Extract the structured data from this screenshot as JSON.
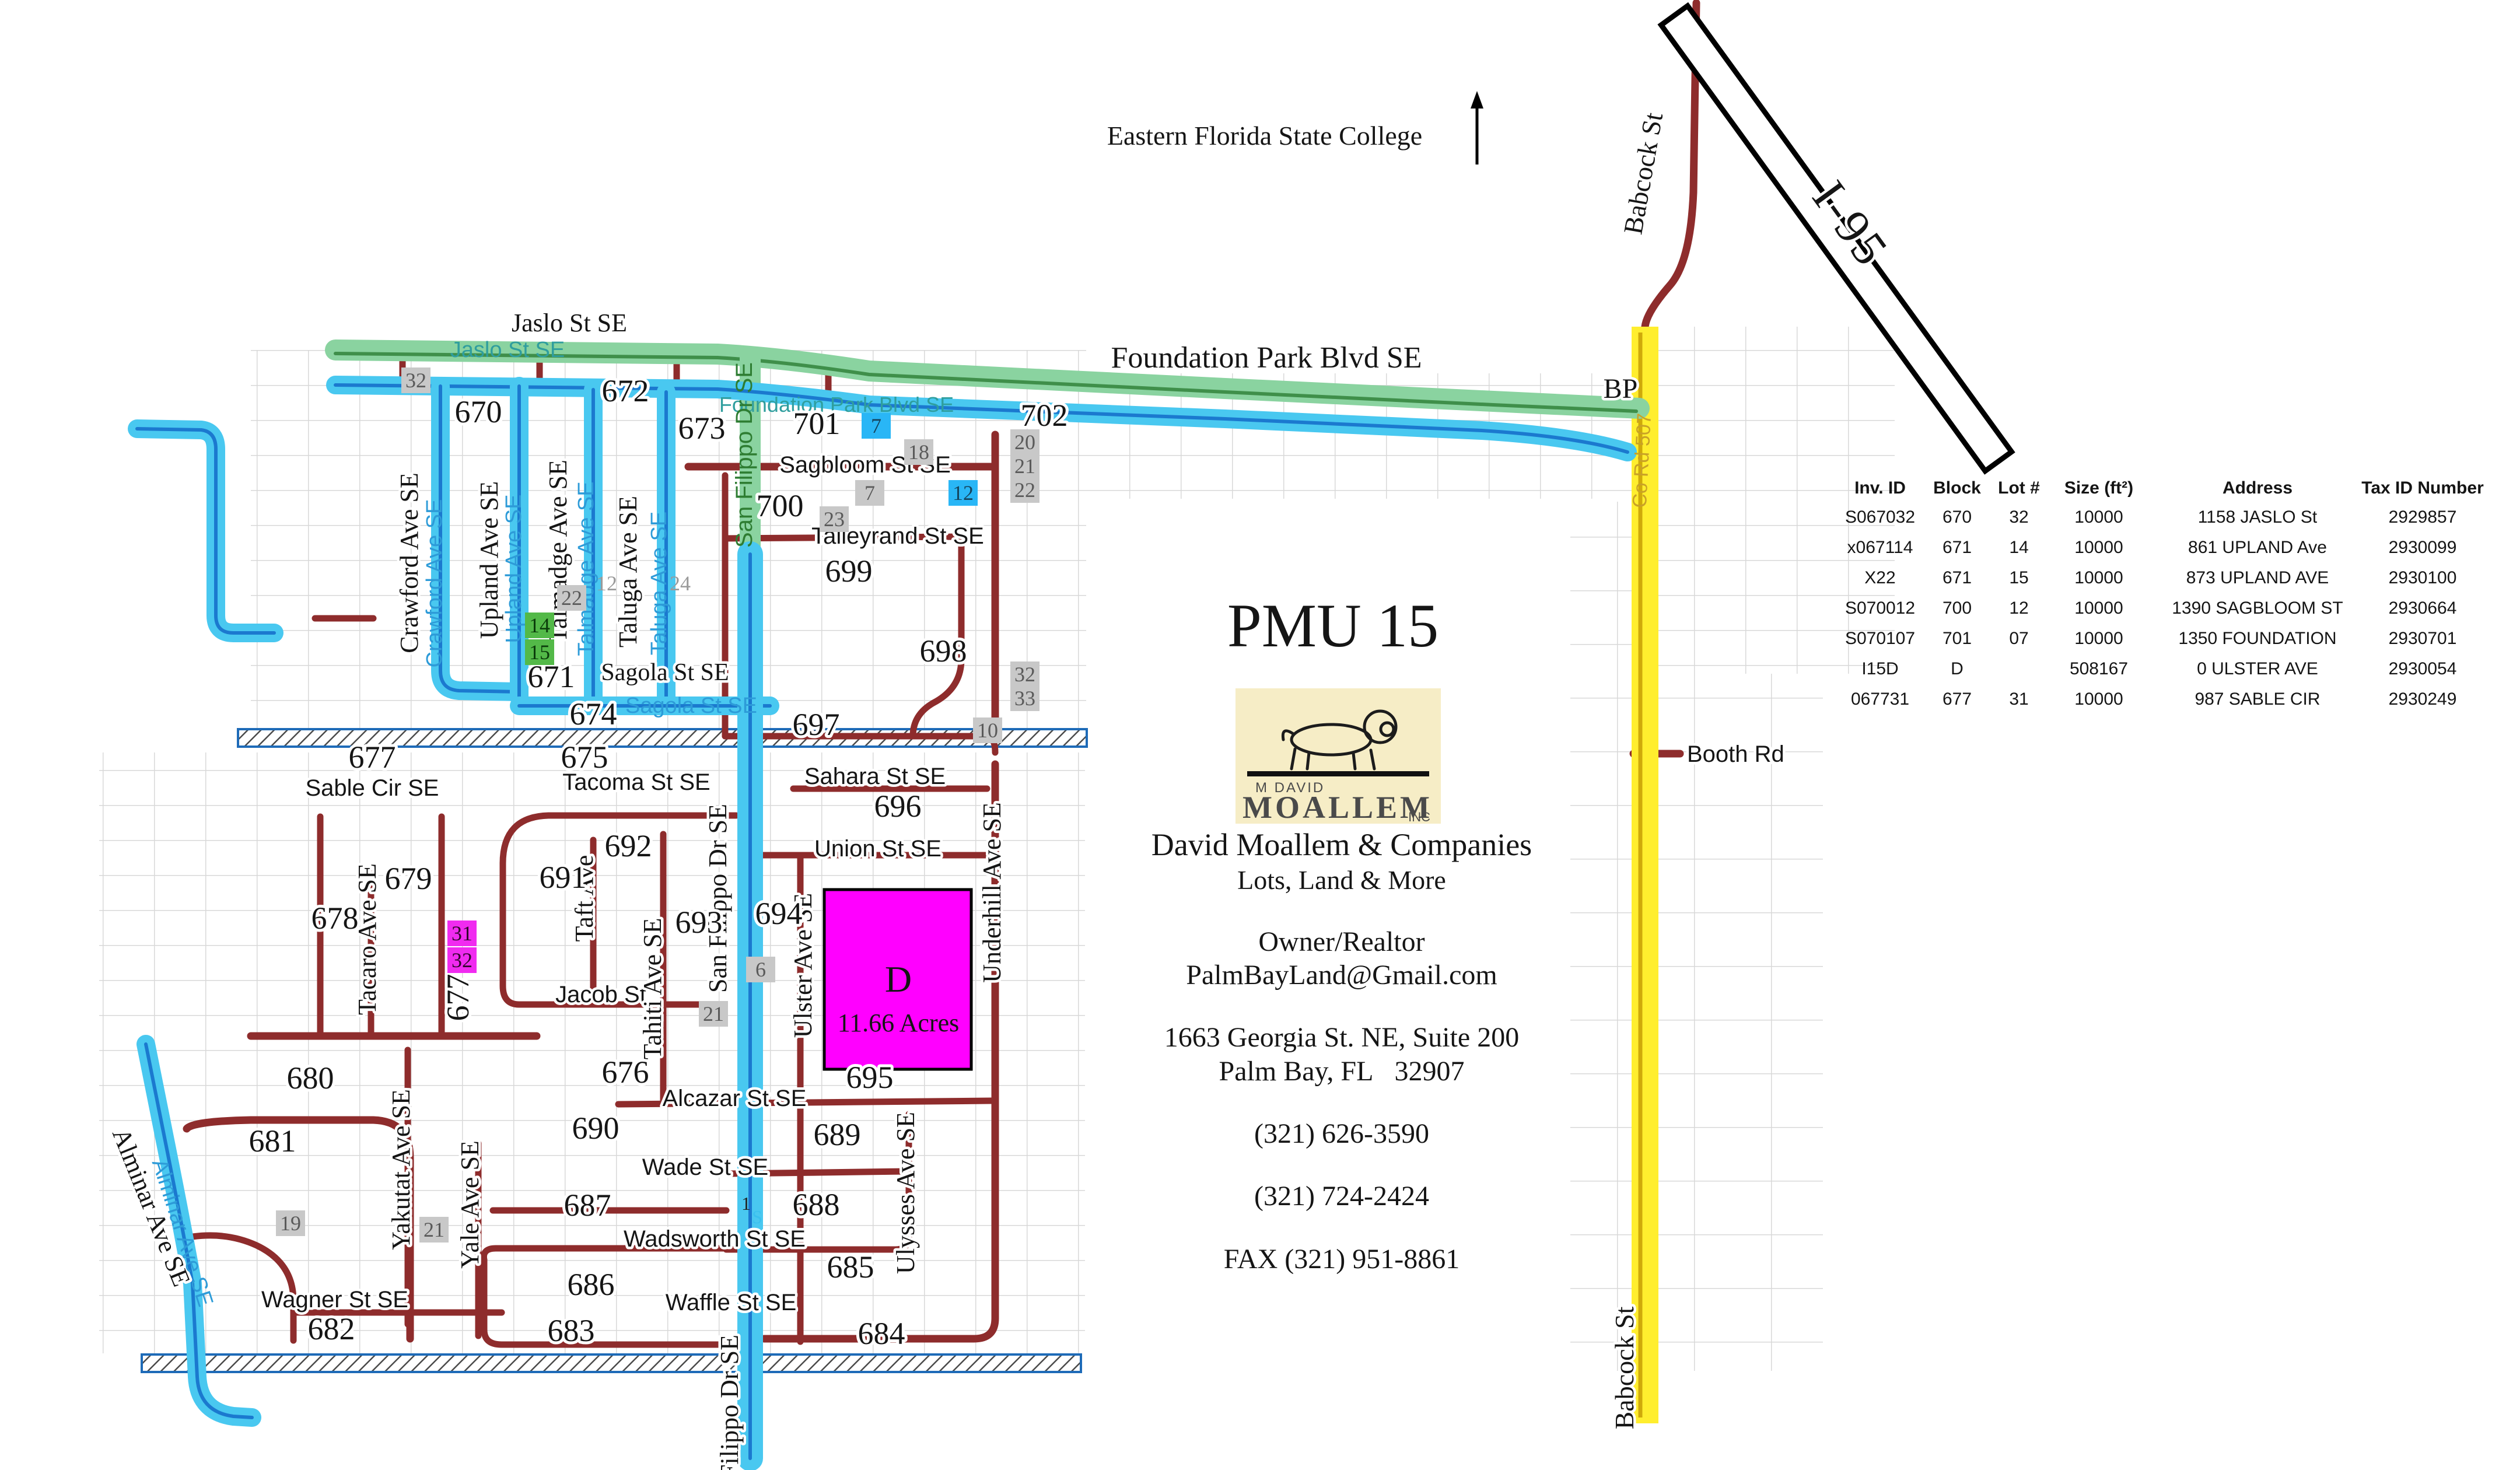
{
  "branding": {
    "title": "PMU 15",
    "logo_top": "M DAVID",
    "logo_name": "MOALLEM",
    "logo_sub": "INC",
    "company": "David Moallem & Companies",
    "tagline": "Lots, Land & More",
    "role": "Owner/Realtor",
    "email": "PalmBayLand@Gmail.com",
    "address1": "1663 Georgia St. NE, Suite 200",
    "address2": "Palm Bay, FL   32907",
    "phone1": "(321) 626-3590",
    "phone2": "(321) 724-2424",
    "fax": "FAX (321) 951-8861"
  },
  "table": {
    "headers": [
      "Inv. ID",
      "Block",
      "Lot #",
      "Size (ft²)",
      "Address",
      "Tax ID Number"
    ],
    "rows": [
      [
        "S067032",
        "670",
        "32",
        "10000",
        "1158 JASLO St",
        "2929857"
      ],
      [
        "x067114",
        "671",
        "14",
        "10000",
        "861 UPLAND Ave",
        "2930099"
      ],
      [
        "X22",
        "671",
        "15",
        "10000",
        "873 UPLAND AVE",
        "2930100"
      ],
      [
        "S070012",
        "700",
        "12",
        "10000",
        "1390 SAGBLOOM ST",
        "2930664"
      ],
      [
        "S070107",
        "701",
        "07",
        "10000",
        "1350 FOUNDATION",
        "2930701"
      ],
      [
        "I15D",
        "D",
        "",
        "508167",
        "0 ULSTER AVE",
        "2930054"
      ],
      [
        "067731",
        "677",
        "31",
        "10000",
        "987 SABLE CIR",
        "2930249"
      ]
    ]
  },
  "parcel": {
    "letter": "D",
    "area": "11.66 Acres"
  },
  "street_labels": [
    {
      "id": "jaslo_big",
      "text": "Jaslo St SE"
    },
    {
      "id": "foundation_big",
      "text": "Foundation Park Blvd SE"
    },
    {
      "id": "college",
      "text": "Eastern Florida State College"
    },
    {
      "id": "bp",
      "text": "BP"
    },
    {
      "id": "booth",
      "text": "Booth Rd"
    },
    {
      "id": "i95",
      "text": "I-95"
    },
    {
      "id": "babcock_top",
      "text": "Babcock St"
    },
    {
      "id": "babcock_bottom",
      "text": "Babcock St"
    },
    {
      "id": "co_rd",
      "text": "Co Rd 507"
    },
    {
      "id": "jaslo_inline",
      "text": "Jaslo St SE"
    },
    {
      "id": "foundation_inline",
      "text": "Foundation Park Blvd SE"
    },
    {
      "id": "crawford_black",
      "text": "Crawford Ave SE"
    },
    {
      "id": "crawford_inline",
      "text": "Crawford Ave SE"
    },
    {
      "id": "upland_black",
      "text": "Upland Ave SE"
    },
    {
      "id": "upland_inline",
      "text": "Upland Ave SE"
    },
    {
      "id": "talmadge_black",
      "text": "Talmadge Ave SE"
    },
    {
      "id": "talmadge_inline",
      "text": "Talmadge Ave SE"
    },
    {
      "id": "taluga_black",
      "text": "Taluga Ave SE"
    },
    {
      "id": "taluga_inline",
      "text": "Taluga Ave SE"
    },
    {
      "id": "sanfilippo_inline_green",
      "text": "San Filippo Dr SE"
    },
    {
      "id": "sanfilippo_mid",
      "text": "San Filippo Dr SE"
    },
    {
      "id": "sanfilippo_bottom",
      "text": "San Filippo Dr SE"
    },
    {
      "id": "sagola_black",
      "text": "Sagola St SE"
    },
    {
      "id": "sagola_inline",
      "text": "Sagola St SE"
    },
    {
      "id": "sagbloom",
      "text": "Sagbloom St SE"
    },
    {
      "id": "talleyrand",
      "text": "Talleyrand St SE"
    },
    {
      "id": "sahara",
      "text": "Sahara St SE"
    },
    {
      "id": "union",
      "text": "Union St SE"
    },
    {
      "id": "tacoma",
      "text": "Tacoma St SE"
    },
    {
      "id": "sable",
      "text": "Sable Cir SE"
    },
    {
      "id": "jacob",
      "text": "Jacob St"
    },
    {
      "id": "alcazar",
      "text": "Alcazar St SE"
    },
    {
      "id": "wade",
      "text": "Wade St SE"
    },
    {
      "id": "wadsworth",
      "text": "Wadsworth St SE"
    },
    {
      "id": "waffle",
      "text": "Waffle St SE"
    },
    {
      "id": "wagner",
      "text": "Wagner St SE"
    },
    {
      "id": "tacaro",
      "text": "Tacaro Ave SE"
    },
    {
      "id": "taft",
      "text": "Taft Ave"
    },
    {
      "id": "tahiti",
      "text": "Tahiti Ave SE"
    },
    {
      "id": "yakutat",
      "text": "Yakutat Ave SE"
    },
    {
      "id": "yale",
      "text": "Yale Ave SE"
    },
    {
      "id": "ulster",
      "text": "Ulster Ave SE"
    },
    {
      "id": "ulysses",
      "text": "Ulysses Ave SE"
    },
    {
      "id": "underhill",
      "text": "Underhill Ave SE"
    },
    {
      "id": "alminar_black",
      "text": "Alminar Ave SE"
    },
    {
      "id": "alminar_inline",
      "text": "Alminar Ave SE"
    }
  ],
  "block_numbers": [
    {
      "id": "b670",
      "text": "670"
    },
    {
      "id": "b671",
      "text": "671"
    },
    {
      "id": "b672",
      "text": "672"
    },
    {
      "id": "b673",
      "text": "673"
    },
    {
      "id": "b674",
      "text": "674"
    },
    {
      "id": "b675",
      "text": "675"
    },
    {
      "id": "b676",
      "text": "676"
    },
    {
      "id": "b677",
      "text": "677"
    },
    {
      "id": "b677r",
      "text": "677"
    },
    {
      "id": "b678",
      "text": "678"
    },
    {
      "id": "b679",
      "text": "679"
    },
    {
      "id": "b680",
      "text": "680"
    },
    {
      "id": "b681",
      "text": "681"
    },
    {
      "id": "b682",
      "text": "682"
    },
    {
      "id": "b683",
      "text": "683"
    },
    {
      "id": "b684",
      "text": "684"
    },
    {
      "id": "b685",
      "text": "685"
    },
    {
      "id": "b686",
      "text": "686"
    },
    {
      "id": "b687",
      "text": "687"
    },
    {
      "id": "b688",
      "text": "688"
    },
    {
      "id": "b689",
      "text": "689"
    },
    {
      "id": "b690",
      "text": "690"
    },
    {
      "id": "b691",
      "text": "691"
    },
    {
      "id": "b692",
      "text": "692"
    },
    {
      "id": "b693",
      "text": "693"
    },
    {
      "id": "b694",
      "text": "694"
    },
    {
      "id": "b695",
      "text": "695"
    },
    {
      "id": "b696",
      "text": "696"
    },
    {
      "id": "b697",
      "text": "697"
    },
    {
      "id": "b698",
      "text": "698"
    },
    {
      "id": "b699",
      "text": "699"
    },
    {
      "id": "b700",
      "text": "700"
    },
    {
      "id": "b701",
      "text": "701"
    },
    {
      "id": "b702",
      "text": "702"
    }
  ],
  "lot_boxes": [
    {
      "id": "g32",
      "text": "32",
      "style": "gray"
    },
    {
      "id": "b7",
      "text": "7",
      "style": "blue"
    },
    {
      "id": "g18",
      "text": "18",
      "style": "gray"
    },
    {
      "id": "g7",
      "text": "7",
      "style": "gray"
    },
    {
      "id": "b12",
      "text": "12",
      "style": "blue"
    },
    {
      "id": "g23",
      "text": "23",
      "style": "gray"
    },
    {
      "id": "g20",
      "text": "20",
      "style": "gray"
    },
    {
      "id": "g21a",
      "text": "21",
      "style": "gray"
    },
    {
      "id": "g22a",
      "text": "22",
      "style": "gray"
    },
    {
      "id": "p12",
      "text": "12",
      "style": "plain"
    },
    {
      "id": "p24",
      "text": "24",
      "style": "plain"
    },
    {
      "id": "g22b",
      "text": "22",
      "style": "gray"
    },
    {
      "id": "gr14",
      "text": "14",
      "style": "green"
    },
    {
      "id": "gr15",
      "text": "15",
      "style": "green"
    },
    {
      "id": "g32b",
      "text": "32",
      "style": "gray"
    },
    {
      "id": "g33",
      "text": "33",
      "style": "gray"
    },
    {
      "id": "g10",
      "text": "10",
      "style": "gray"
    },
    {
      "id": "m31",
      "text": "31",
      "style": "magenta"
    },
    {
      "id": "m32",
      "text": "32",
      "style": "magenta"
    },
    {
      "id": "g6",
      "text": "6",
      "style": "gray"
    },
    {
      "id": "g21b",
      "text": "21",
      "style": "gray"
    },
    {
      "id": "g19",
      "text": "19",
      "style": "gray"
    },
    {
      "id": "g21c",
      "text": "21",
      "style": "gray"
    },
    {
      "id": "t1",
      "text": "1",
      "style": "tiny"
    },
    {
      "id": "tS",
      "text": "S",
      "style": "tinyblue"
    }
  ],
  "accent_colors": {
    "blue_road": "#49c8f0",
    "green_road": "#8ad3a0",
    "yellow_road": "#ffee2e",
    "dark_red_road": "#8e2c2c",
    "magenta_parcel": "#ff00ff",
    "logo_cream": "#f6edc6"
  }
}
